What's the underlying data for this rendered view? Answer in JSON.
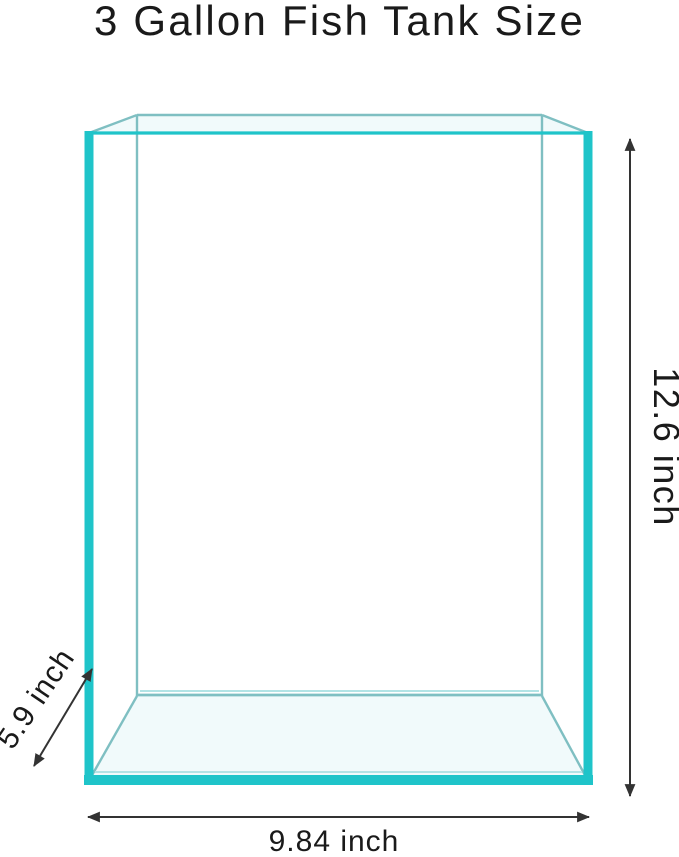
{
  "title": "3 Gallon Fish Tank Size",
  "diagram": {
    "subject": "fish-tank-wireframe",
    "labels": {
      "height": "12.6 inch",
      "depth": "5.9 inch",
      "width": "9.84 inch"
    },
    "values": {
      "capacity_gallons": 3,
      "height_inches": 12.6,
      "depth_inches": 5.9,
      "width_inches": 9.84,
      "unit": "inch"
    },
    "colors": {
      "glass_front": "#1fc4c9",
      "glass_back": "#7fbfc2",
      "glass_light": "#b2e3e5",
      "dimension": "#333333",
      "text": "#1a1a1a",
      "background": "#ffffff"
    }
  }
}
